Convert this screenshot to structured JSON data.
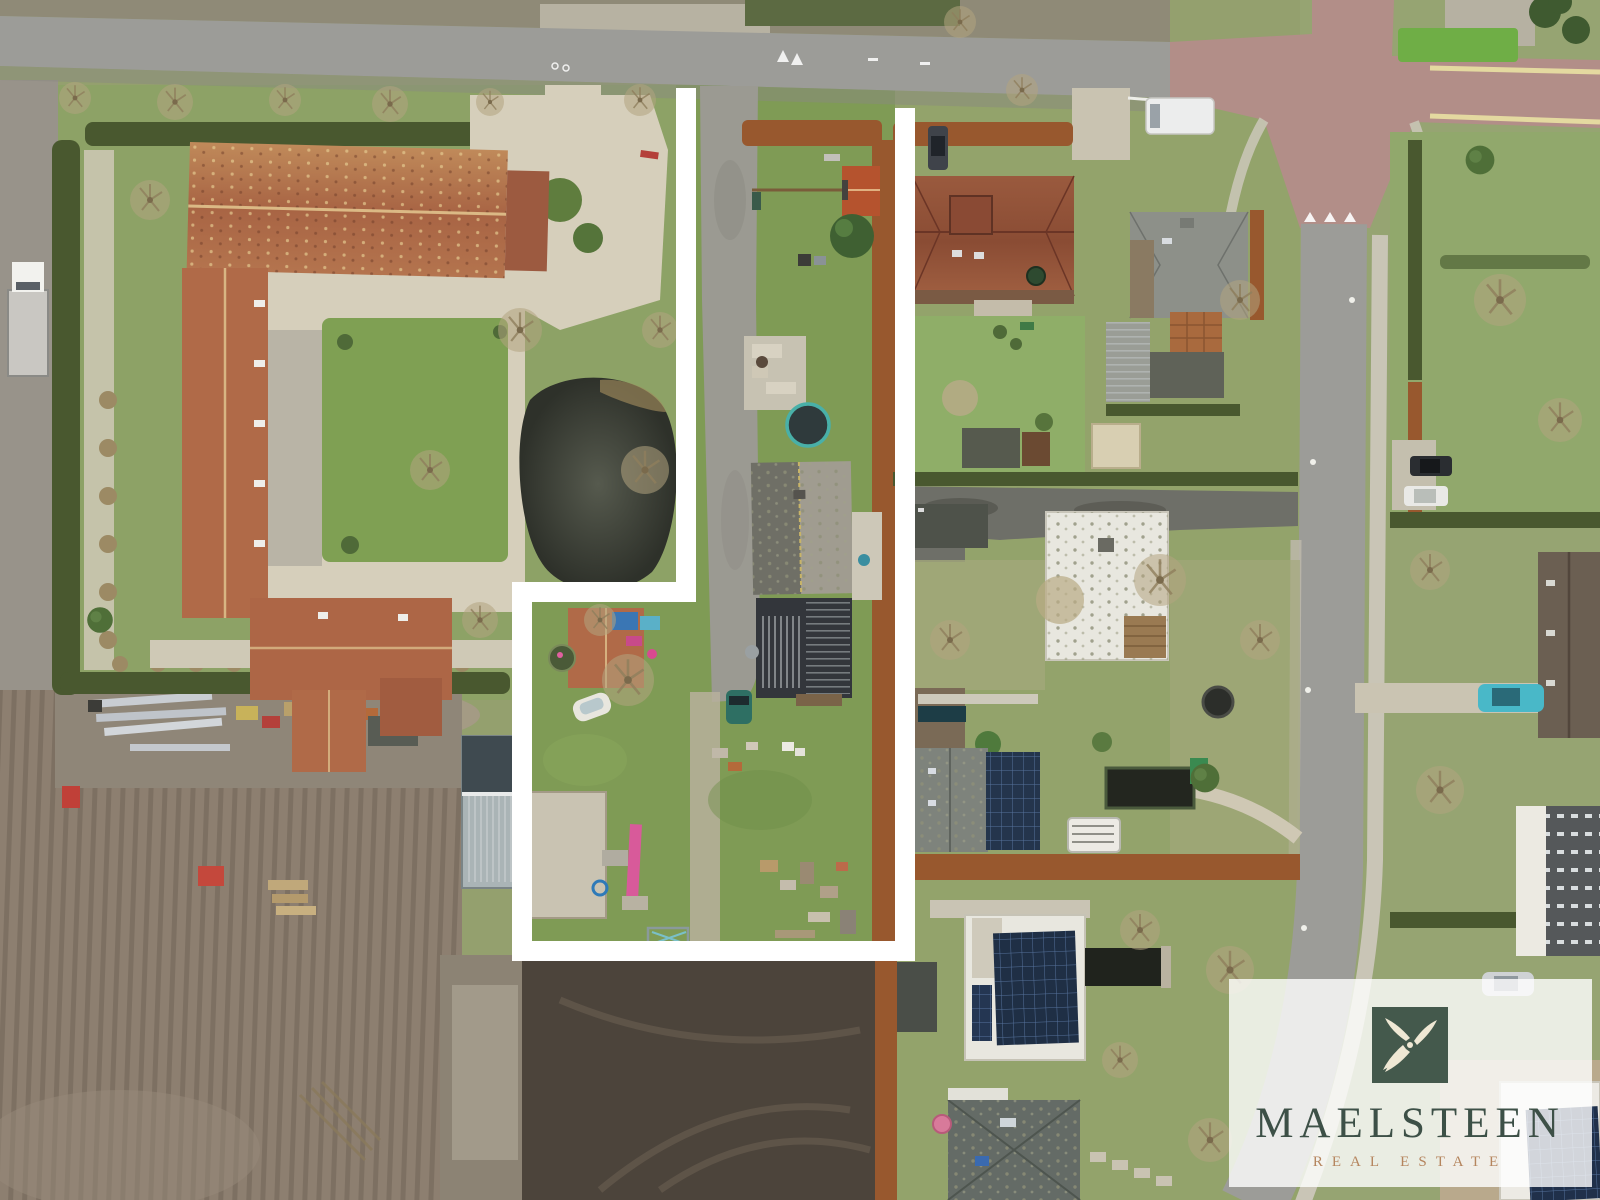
{
  "meta": {
    "image_type": "aerial-drone-photo",
    "subject": "building plot for sale outlined in white between a farmstead and a residential street"
  },
  "watermark": {
    "brand": "MAELSTEEN",
    "tagline": "REAL ESTATE",
    "icon": "windmill-icon",
    "panel_color": "rgba(255,255,255,0.80)",
    "icon_bg_color": "rgba(39,62,49,0.85)",
    "icon_glyph_color": "#efe8d4",
    "brand_color": "#3d5047",
    "tagline_color": "#b5855e"
  },
  "plot_boundary": {
    "color": "#ffffff",
    "stroke_width": 20,
    "points": [
      [
        686,
        88
      ],
      [
        686,
        592
      ],
      [
        522,
        592
      ],
      [
        522,
        951
      ],
      [
        905,
        951
      ],
      [
        905,
        108
      ]
    ]
  },
  "palette": {
    "grass-base": "#94a06e",
    "grass-bright": "#7f9b55",
    "grass-pale": "#a8a883",
    "road-gray": "#9c9c98",
    "road-red": "#b28e88",
    "sidewalk": "#c9c5b6",
    "gravel": "#d6cfbb",
    "hedge-dark": "#49582f",
    "hedge-rust": "#98582e",
    "roof-terracotta": "#b06a48",
    "roof-gray": "#8d9089",
    "roof-dark": "#33363b",
    "roof-white": "#e8e7df",
    "pond": "#383b33",
    "field": "#8d7f70",
    "soil-dark": "#4c443b",
    "solar": "#24354c",
    "brand-color": "#3d5047",
    "tagline-color": "#b5855e"
  },
  "scene": {
    "landmarks": [
      {
        "name": "top-road",
        "desc": "gray asphalt street along top edge"
      },
      {
        "name": "red-junction",
        "desc": "reddish paved crossroads top right"
      },
      {
        "name": "right-road",
        "desc": "vertical street down right side"
      },
      {
        "name": "farmstead",
        "desc": "U-shaped farmhouse with terracotta roofs and courtyard garden"
      },
      {
        "name": "farm-pond",
        "desc": "dark garden pond"
      },
      {
        "name": "plot-driveway",
        "desc": "long asphalt drive inside outlined plot"
      },
      {
        "name": "plot-house",
        "desc": "gable-roof house with dark annex on plot"
      },
      {
        "name": "plot-garden-shed",
        "desc": "small red-roof shed at rear of plot"
      },
      {
        "name": "trampoline",
        "desc": "round trampoline on plot lawn"
      },
      {
        "name": "red-roof-house",
        "desc": "neighbouring house with red tile roof"
      },
      {
        "name": "gray-roof-house",
        "desc": "neighbouring house with gray roof"
      },
      {
        "name": "white-flat-roof-building",
        "desc": "white flat-roof building mid right"
      },
      {
        "name": "modern-houses-solar",
        "desc": "modern houses with solar panel arrays bottom right"
      },
      {
        "name": "plowed-field",
        "desc": "large bare field bottom left"
      },
      {
        "name": "dark-soil-yard",
        "desc": "excavated dark soil area bottom centre"
      },
      {
        "name": "greenhouse",
        "desc": "small glasshouse at field edge"
      },
      {
        "name": "materials-laydown",
        "desc": "strip of stored building materials and pallets"
      },
      {
        "name": "parked-vehicles",
        "desc": "van, cars and truck parked along streets"
      }
    ]
  }
}
